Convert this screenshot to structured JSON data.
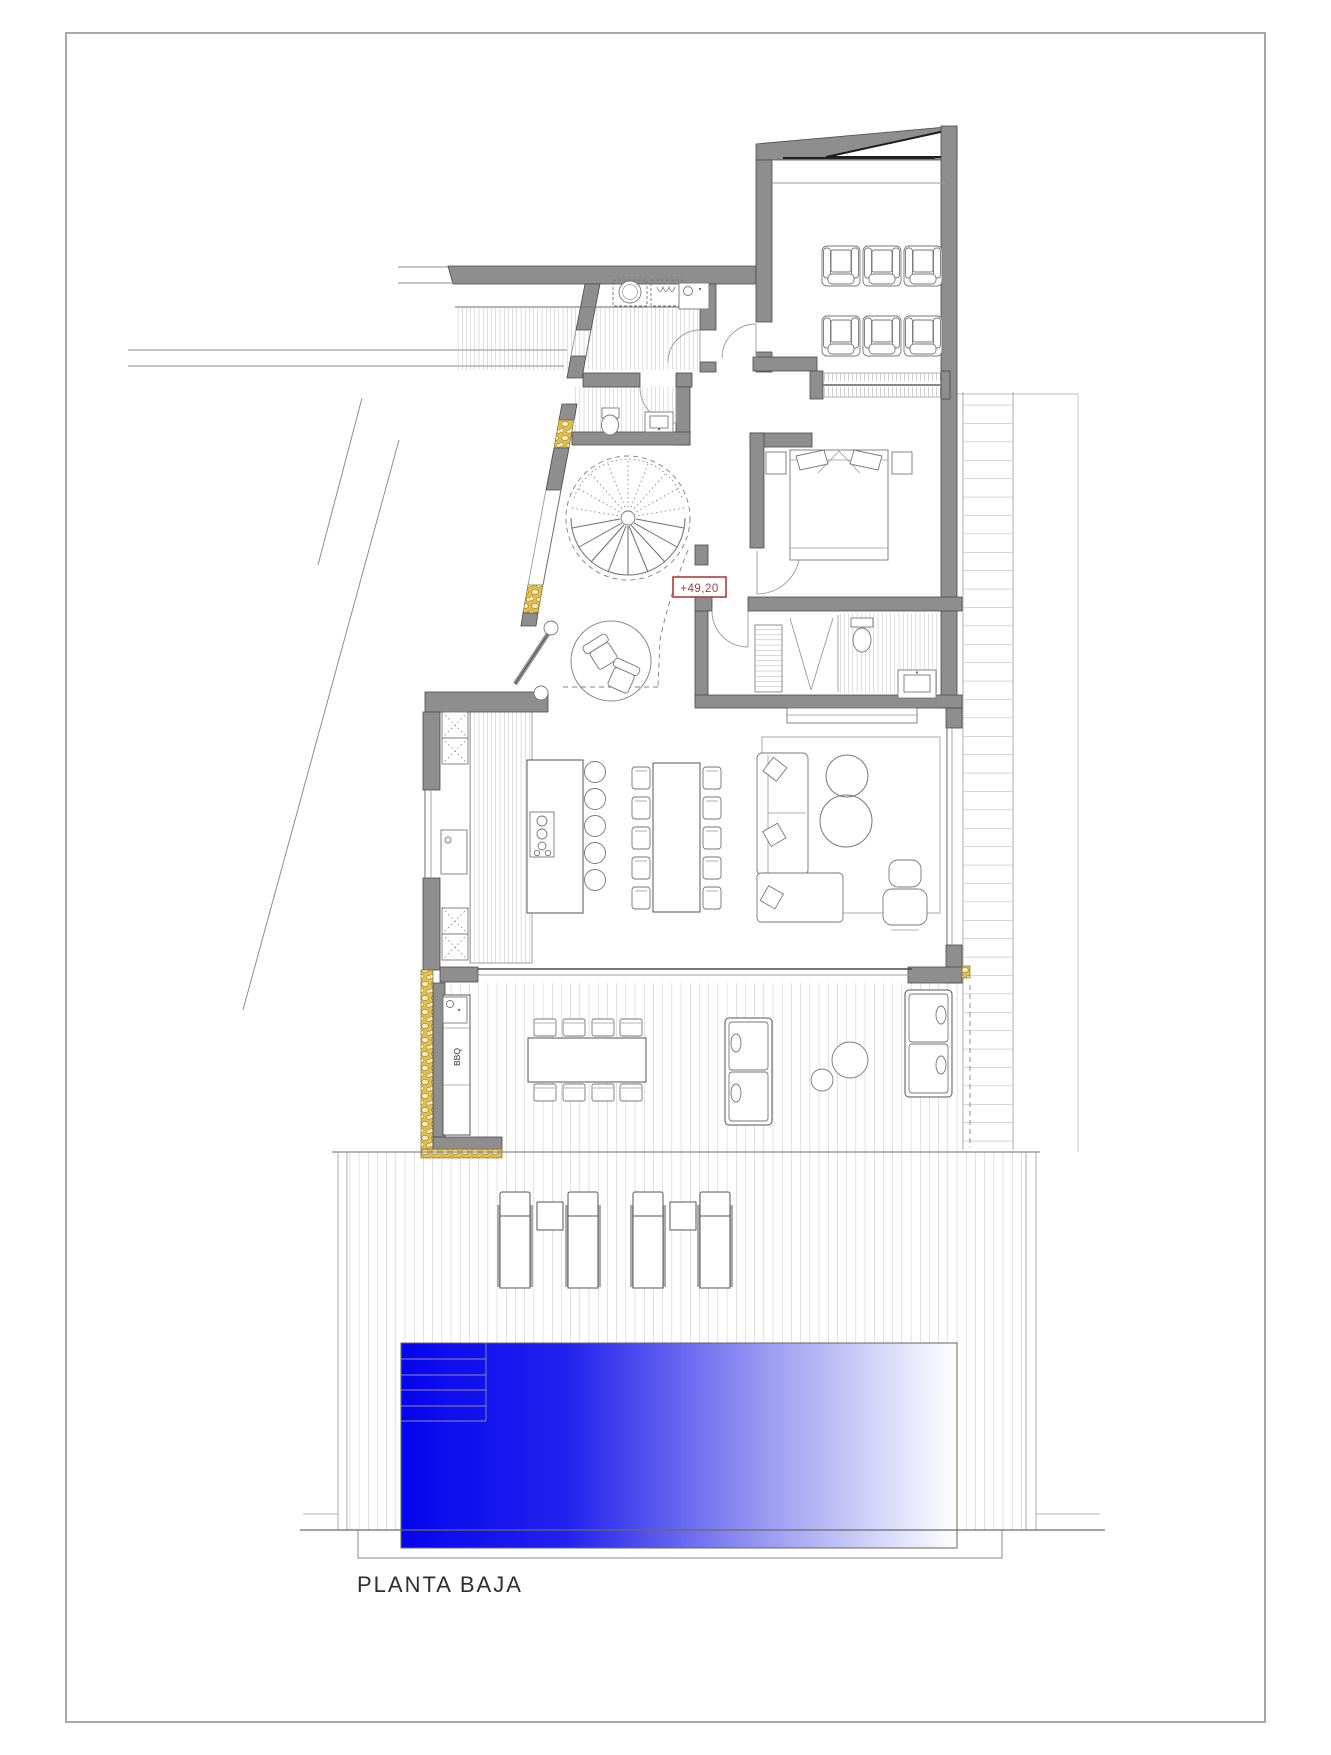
{
  "page": {
    "plan_title": "PLANTA BAJA"
  },
  "annotations": {
    "elevation_marker": "+49,20",
    "bbq_label": "BBQ"
  },
  "colors": {
    "wall_gray": "#8e8e8e",
    "stone_gold": "#e3bf4e",
    "marker_red": "#b23b3b",
    "pool_blue": "#0505ee",
    "pool_fade": "#ffffff",
    "drawing_line": "#6e6e6e",
    "deck_plank_line": "#b8b8b8"
  },
  "icons": {
    "spiral-stair-icon": "radial tread fan with dotted upper flight",
    "washer-icon": "dashed box with drum circle",
    "dryer-icon": "dashed box with wavy glyph",
    "sink-icon": "box with faucet dot",
    "toilet-icon": "tank + bowl",
    "shower-icon": "V glass lines",
    "bed-icon": "rectangle with headboard and pillows",
    "armchair-icon": "rounded square with armrests",
    "sofa-icon": "modules with cushions",
    "sun-lounger-icon": "rails + mattress",
    "bbq-counter-icon": "counter with sink square",
    "pool-icon": "blue gradient basin with steps"
  }
}
